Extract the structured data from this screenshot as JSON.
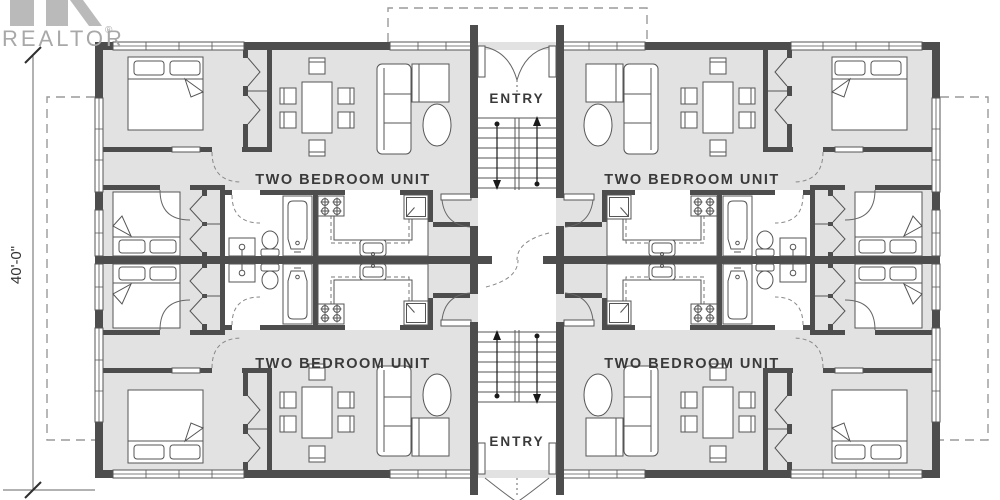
{
  "branding": {
    "name": "REALTOR",
    "mark": "®"
  },
  "dimension": {
    "height": "40'-0\""
  },
  "entries": {
    "top": "ENTRY",
    "bottom": "ENTRY"
  },
  "units": {
    "top_left": "TWO BEDROOM UNIT",
    "top_right": "TWO BEDROOM UNIT",
    "bottom_left": "TWO BEDROOM UNIT",
    "bottom_right": "TWO BEDROOM UNIT"
  },
  "colors": {
    "wall": "#4d4d4d",
    "floor": "#e2e2e2",
    "line": "#555555",
    "dashed_outline": "#9a9a9a",
    "text": "#3a3a3a",
    "logo": "#a8a8a8",
    "background": "#ffffff"
  }
}
